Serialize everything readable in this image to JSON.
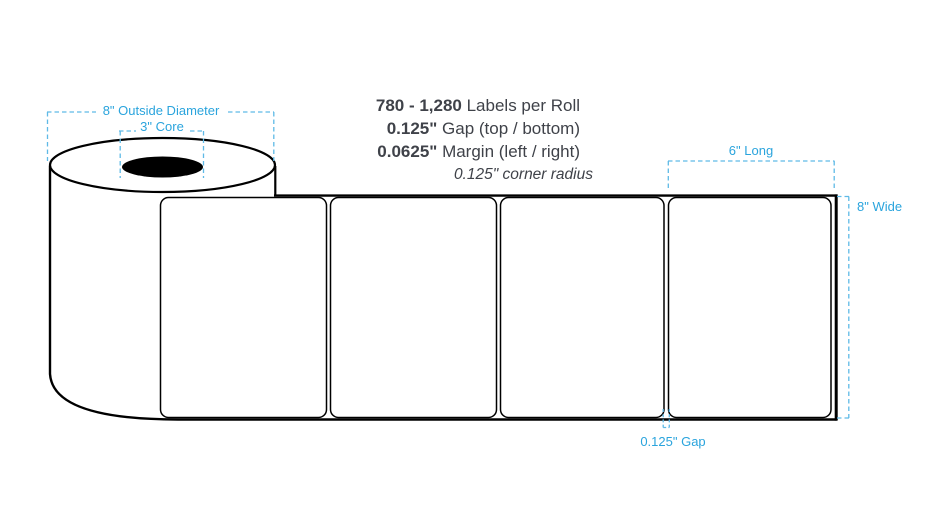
{
  "specs": {
    "lines": [
      {
        "value": "780 - 1,280",
        "label": " Labels per Roll"
      },
      {
        "value": "0.125\"",
        "label": " Gap (top / bottom)"
      },
      {
        "value": "0.0625\"",
        "label": " Margin (left / right)"
      }
    ],
    "corner_radius_note": "0.125\" corner radius"
  },
  "annotations": {
    "outside_diameter": "8\" Outside Diameter",
    "core": "3\" Core",
    "label_length": "6\" Long",
    "roll_width": "8\" Wide",
    "label_gap": "0.125\" Gap"
  },
  "diagram": {
    "label_count": "4",
    "colors": {
      "annotation_blue": "#2aa4dd",
      "dash_blue": "#5fbae6",
      "outline_black": "#000000",
      "spec_text_dark": "#3f4249",
      "background": "#ffffff"
    }
  }
}
